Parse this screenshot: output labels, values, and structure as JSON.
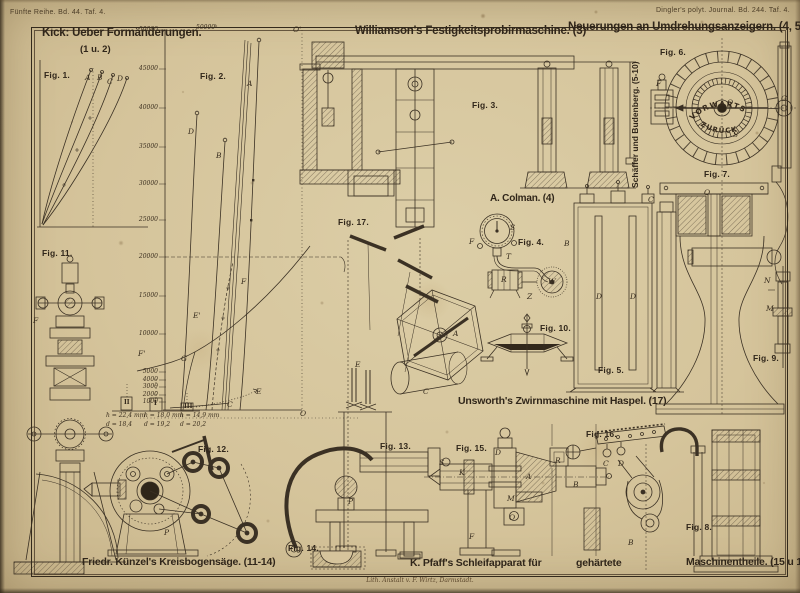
{
  "page": {
    "header_left": "Fünfte Reihe. Bd. 44. Taf. 4.",
    "header_right": "Dingler's polyt. Journal. Bd. 244. Taf. 4.",
    "credit": "Lith. Anstalt v. F. Wirtz, Darmstadt."
  },
  "titles": {
    "kick": "Kick: Ueber Formänderungen.",
    "kick_ref": "(1 u. 2)",
    "williamson": "Williamson's Festigkeitsprobirmaschine. (3)",
    "umdrehung": "Neuerungen an Umdrehungsanzeigern. (4, 5-10)",
    "colman": "A. Colman. (4)",
    "schaeffer": "Schäffer und Budenberg. (5-10)",
    "unsworth": "Unsworth's Zwirnmaschine mit Haspel. (17)",
    "kuenzel": "Friedr. Künzel's Kreisbogensäge. (11-14)",
    "pfaff_1": "K. Pfaff's Schleifapparat für",
    "pfaff_2": "gehärtete",
    "pfaff_3": "Maschinentheile. (15 u 16)"
  },
  "figure_labels": {
    "fig1": "Fig. 1.",
    "fig2": "Fig. 2.",
    "fig3": "Fig. 3.",
    "fig4": "Fig. 4.",
    "fig5": "Fig. 5.",
    "fig6": "Fig. 6.",
    "fig7": "Fig. 7.",
    "fig8": "Fig. 8.",
    "fig9": "Fig. 9.",
    "fig10": "Fig. 10.",
    "fig11": "Fig. 11.",
    "fig12": "Fig. 12.",
    "fig13": "Fig. 13.",
    "fig14": "Fig. 14.",
    "fig15": "Fig. 15.",
    "fig16": "Fig. 16.",
    "fig17": "Fig. 17."
  },
  "fig1": {
    "letters": [
      "A",
      "B",
      "C",
      "D"
    ]
  },
  "fig2": {
    "ticks": [
      "50000",
      "45000",
      "40000",
      "35000",
      "30000",
      "25000",
      "20000",
      "15000",
      "10000",
      "5000",
      "4000",
      "3000",
      "2000",
      "1000"
    ],
    "top_label": "50000ᵏ",
    "curve_labels": [
      "A",
      "B",
      "D",
      "F'",
      "F",
      "E'",
      "E",
      "G",
      "C"
    ],
    "origin_labels": [
      "O'",
      "O"
    ],
    "specimens": [
      "II",
      "I",
      "III"
    ],
    "annotations": [
      {
        "h": "h = 22,4 mm",
        "d": "d = 18,4"
      },
      {
        "h": "h = 18,0 mm",
        "d": "d = 19,2"
      },
      {
        "h": "h = 14,9 mm",
        "d": "d = 20,2"
      }
    ]
  },
  "fig4": {
    "letters": [
      "F",
      "S",
      "T",
      "R",
      "W",
      "Z"
    ]
  },
  "fig5": {
    "letters": [
      "B",
      "D",
      "D",
      "C"
    ]
  },
  "fig6": {
    "dial_up": "VORWÄRTS",
    "dial_down": "ZURÜCK",
    "letters": [
      "F",
      "O",
      "G",
      "S"
    ]
  },
  "fig7": {
    "letters": [
      "O"
    ]
  },
  "fig9": {
    "letters": [
      "N",
      "M"
    ]
  },
  "fig11": {
    "letters": [
      "F"
    ]
  },
  "fig12": {
    "letters": [
      "P"
    ]
  },
  "fig13": {
    "letters": [
      "P"
    ]
  },
  "fig15": {
    "letters": [
      "S",
      "K",
      "D",
      "A",
      "R",
      "B",
      "M",
      "O",
      "F"
    ]
  },
  "fig16": {
    "letters": [
      "C",
      "D",
      "B"
    ]
  },
  "fig17": {
    "letters": [
      "A",
      "C",
      "E"
    ]
  }
}
